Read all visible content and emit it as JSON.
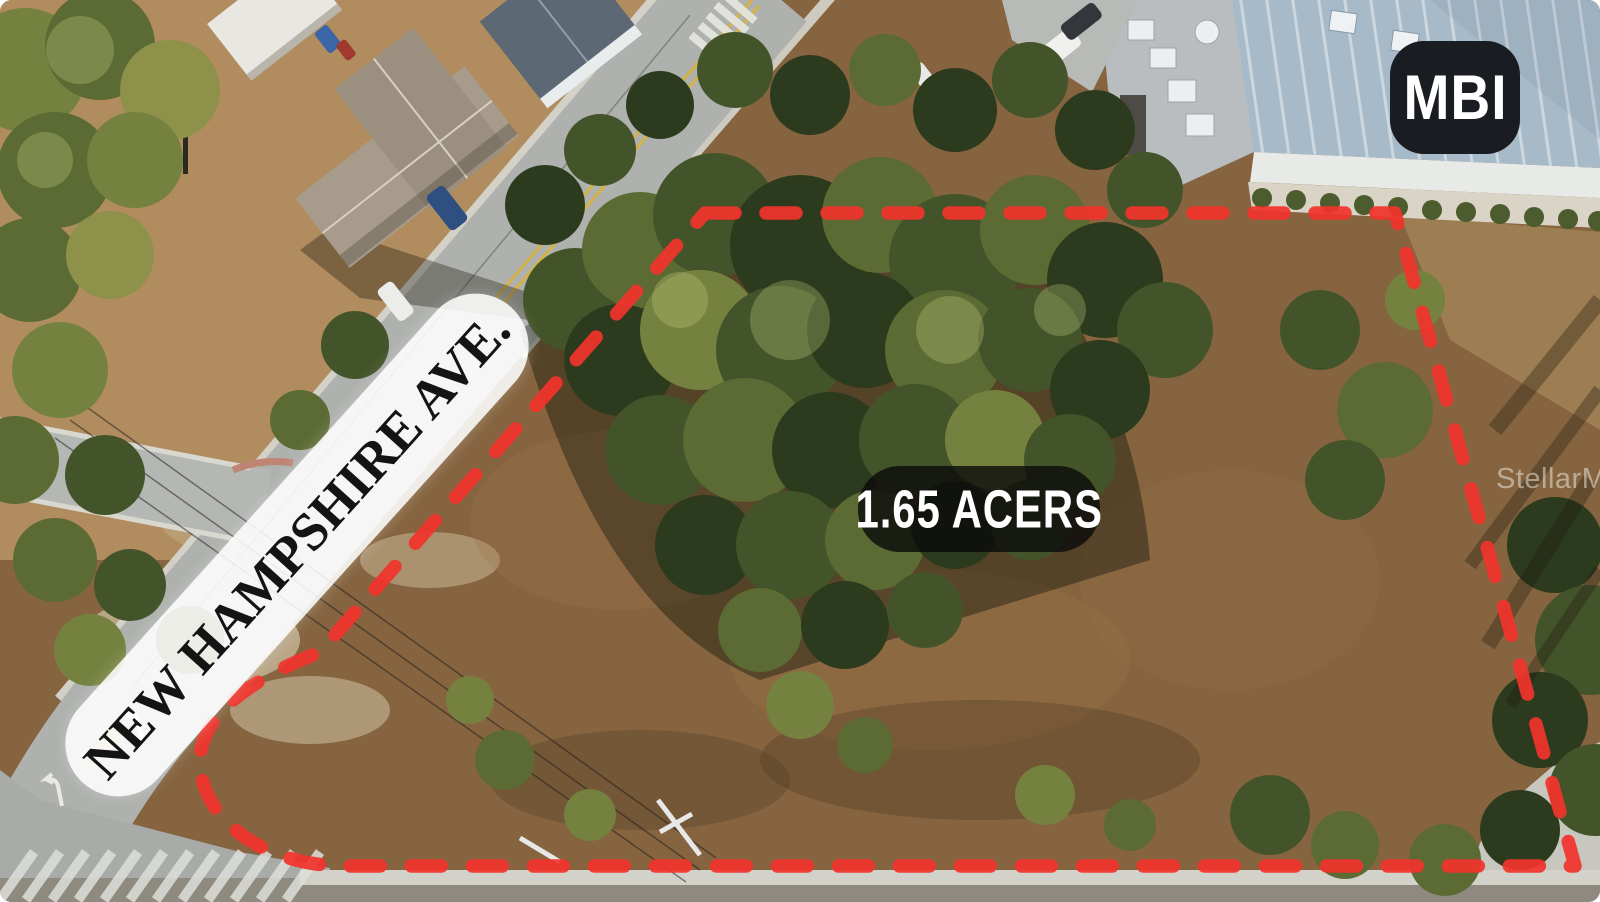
{
  "image": {
    "street_label": "NEW HAMPSHIRE AVE.",
    "acreage_label": "1.65 ACERS",
    "brand_badge": "MBI",
    "watermark": "StellarMLS"
  },
  "colors": {
    "boundary": "#f1342c",
    "badge_bg": "#191c20",
    "badge_text": "#ffffff",
    "acreage_bg": "#0a0a0a",
    "acreage_text": "#ffffff",
    "banner_bg": "#ffffff",
    "street_text": "#141414",
    "watermark_text": "#eae5da"
  }
}
